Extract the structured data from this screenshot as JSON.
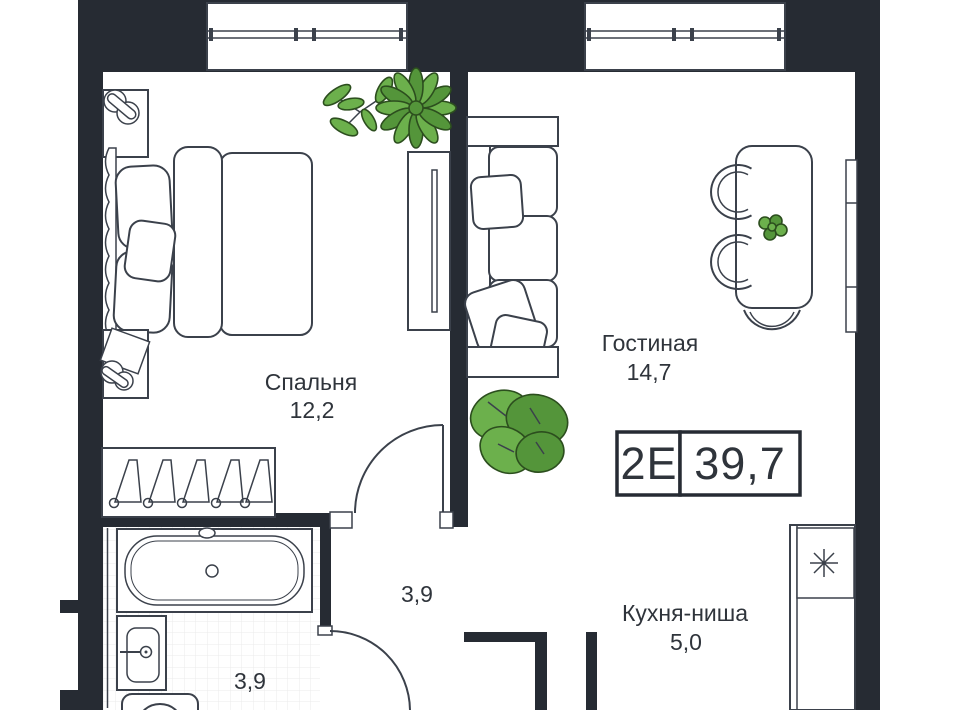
{
  "plan": {
    "badge": {
      "unit_type": "2Е",
      "total_area": "39,7"
    },
    "rooms": {
      "bedroom": {
        "label": "Спальня",
        "area": "12,2"
      },
      "living": {
        "label": "Гостиная",
        "area": "14,7"
      },
      "kitchen": {
        "label": "Кухня-ниша",
        "area": "5,0"
      },
      "hallway": {
        "area": "3,9"
      },
      "bathroom": {
        "area": "3,9"
      }
    },
    "colors": {
      "wall": "#262b33",
      "furniture_line": "#3b414b",
      "text": "#2f343b",
      "plant_green": "#6cb04c",
      "plant_green_dark": "#54953a",
      "plant_outline": "#2c4e1e",
      "tile_grid": "#ebebeb"
    }
  }
}
